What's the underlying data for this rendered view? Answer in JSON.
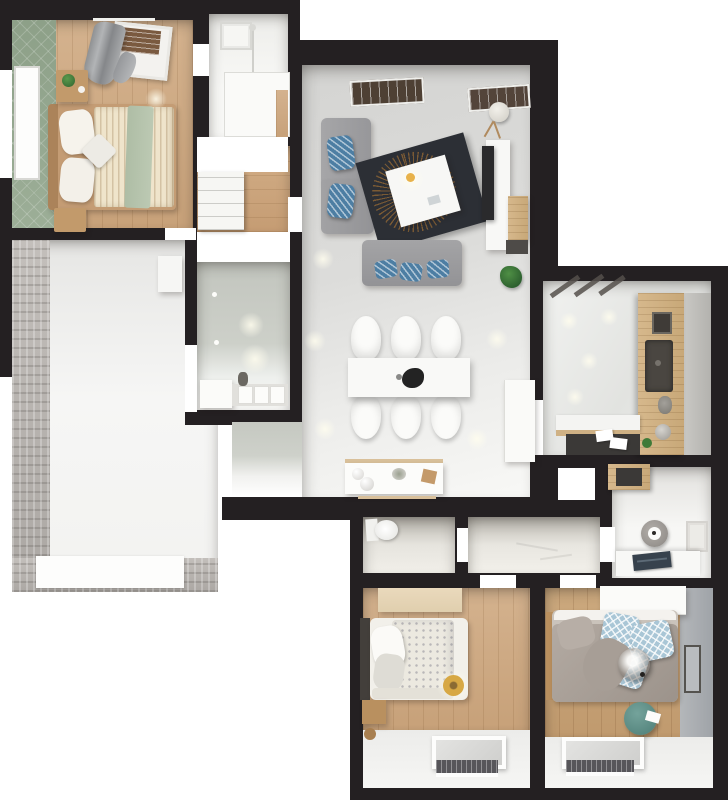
{
  "scene": {
    "kind": "3d-floor-plan-render",
    "view": "top-down",
    "background_color": "#ffffff",
    "wall_color": "#242022"
  },
  "palette": {
    "wood_floor": "#cbaa83",
    "oak_counter": "#cfb184",
    "green_accent_wall": "#94a78f",
    "stone_wall": "#bab6b2",
    "living_floor_gray": "#d9d9d7",
    "bath_wall_gray_green": "#c7cac3",
    "sofa_gray": "#9d9da0",
    "pillow_blue": "#4d7ea3",
    "pillow_diamond_blue": "#a9c6d6",
    "rug_dark": "#2c2f35",
    "rug_fan_orange": "#ba7d34",
    "duvet_cream_stripe": "#efe4cb",
    "throw_sage": "#b4c3ab",
    "duvet_gray": "#a59c94",
    "pouf_teal": "#5f948e",
    "laptop_navy": "#37424d",
    "radiator_dark": "#57565a"
  },
  "rooms": [
    {
      "id": "bedroom-1",
      "name": "Bedroom 1 (top left): double bed, striped duvet, sage throw, green tiled accent wall, curtain, two nightstands"
    },
    {
      "id": "shower-room",
      "name": "Shower room (top middle): walk-in shower, ceiling vent"
    },
    {
      "id": "hallway",
      "name": "Hallway with wardrobe shelves, wood floor"
    },
    {
      "id": "bathroom",
      "name": "Bathroom: vanity with sink, towels, mirror lights"
    },
    {
      "id": "terrace",
      "name": "Terrace / unfinished room: stone accent wall, stone border floor, white inset"
    },
    {
      "id": "living-room",
      "name": "Living + dining room: corner sofa, second sofa, dark round-pattern rug, white coffee table, TV unit, floor lamp, plant, dining table with six chairs, sideboard"
    },
    {
      "id": "kitchen",
      "name": "Kitchen: L-shaped oak counter, dark sink, toaster, island with papers"
    },
    {
      "id": "wc",
      "name": "WC with toilet"
    },
    {
      "id": "corridor",
      "name": "Corridor"
    },
    {
      "id": "utility-nook",
      "name": "Utility / desk nook: wall holder, desk with laptop, vent, oak cabinet"
    },
    {
      "id": "bedroom-2",
      "name": "Bedroom 2 (bottom left): single bed with dotted duvet, desk, nightstand, roof window, radiator"
    },
    {
      "id": "bedroom-3",
      "name": "Bedroom 3 (bottom right): double bed with gray duvet and blue diamond pillows, pendant lamp, wardrobe, teal pouf, picture frame, roof window, radiator"
    }
  ]
}
